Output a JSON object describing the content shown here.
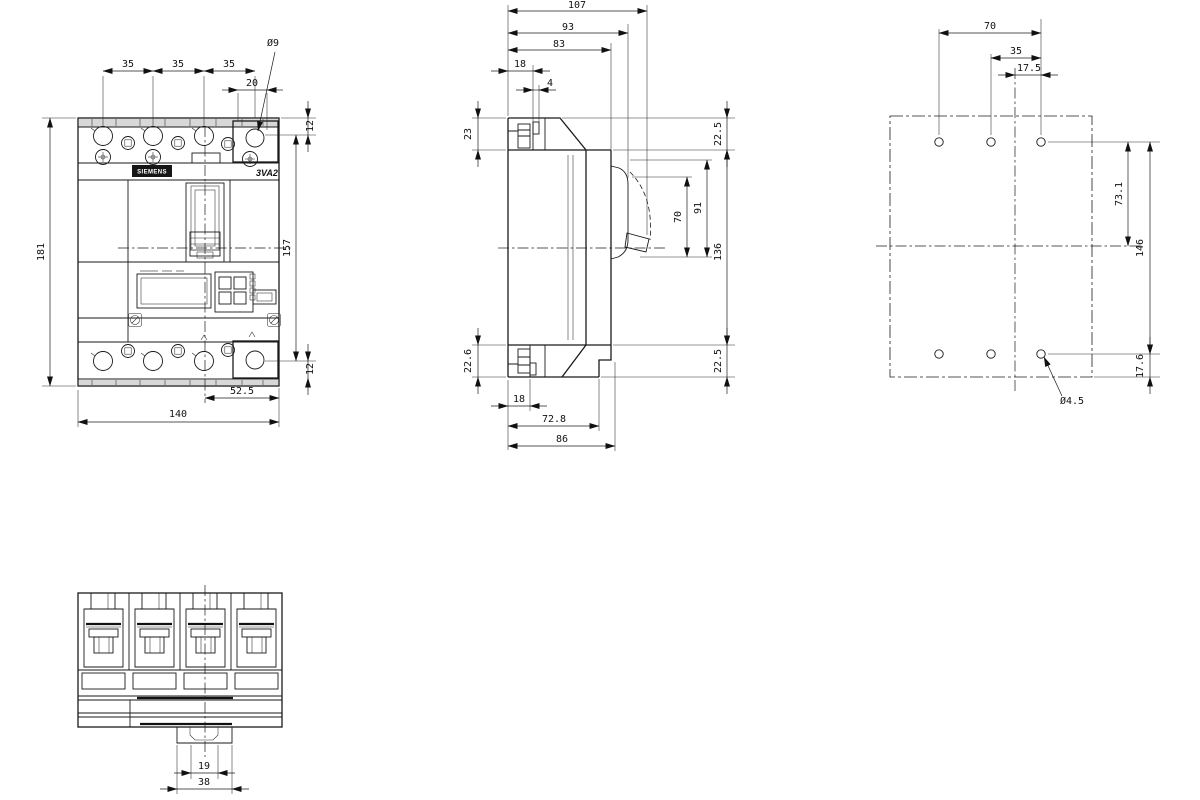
{
  "drawing": {
    "brand": "SIEMENS",
    "model": "3VA2",
    "front": {
      "pitch_1": "35",
      "pitch_2": "35",
      "pitch_3": "35",
      "terminal_hole_dia": "Ø9",
      "hole_to_edge": "20",
      "top_edge_to_hole": "12",
      "overall_height": "181",
      "terminal_span": "157",
      "bottom_edge_to_hole": "12",
      "pole_center_to_edge": "52.5",
      "overall_width": "140"
    },
    "side": {
      "depth_overall": "107",
      "depth_to_escutcheon": "93",
      "depth_to_cover": "83",
      "bracket_depth": "18",
      "bracket_tab": "4",
      "terminal_depth_top": "23",
      "top_offset": "22.5",
      "handle_window": "70",
      "escutcheon_window": "91",
      "mounting_height": "136",
      "bottom_offset": "22.5",
      "terminal_depth_bottom": "22.6",
      "foot_depth": "18",
      "base_depth": "72.8",
      "overall_base_depth": "86"
    },
    "drill": {
      "hole_span": "70",
      "hole_pitch": "35",
      "center_to_hole": "17.5",
      "top_row_to_center": "73.1",
      "row_span": "146",
      "bottom_row_to_edge": "17.6",
      "hole_dia": "Ø4.5"
    },
    "bottom": {
      "rail_notch": "19",
      "rail_tab": "38"
    }
  }
}
